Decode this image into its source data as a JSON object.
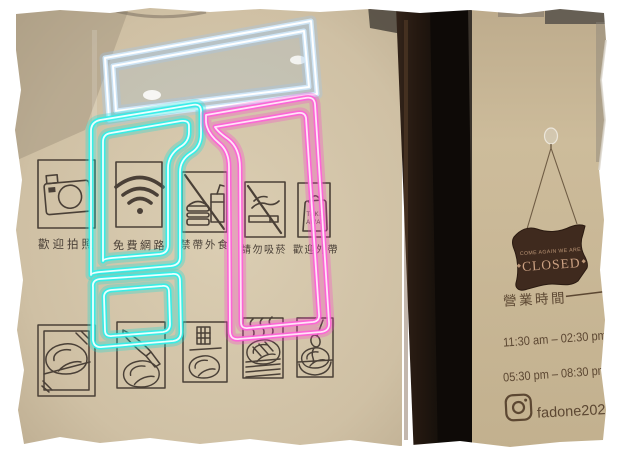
{
  "store": {
    "house_rules": [
      {
        "icon": "camera",
        "label": "歡迎拍照"
      },
      {
        "icon": "wifi",
        "label": "免費網路"
      },
      {
        "icon": "no-outside-food",
        "label": "禁帶外食"
      },
      {
        "icon": "no-smoking",
        "label": "請勿吸菸"
      },
      {
        "icon": "takeaway-bag",
        "label": "歡迎外帶"
      }
    ],
    "takeaway_bag_text": {
      "line1": "TAKE",
      "line2": "AWAY"
    },
    "closed_sign": {
      "top_line": "COME AGAIN WE ARE",
      "main": "CLOSED"
    },
    "hours": {
      "title": "營業時間",
      "lines": [
        "11:30 am – 02:30 pm",
        "05:30 pm – 08:30 pm"
      ]
    },
    "instagram": {
      "handle": "fadone2021"
    },
    "colors": {
      "neon_top": "#cfe8fb",
      "neon_left": "#2ff0ea",
      "neon_right": "#ff5fd8",
      "wall": "#d3c5aa",
      "icon_ink": "#4a4037",
      "hours_ink": "#5c4732",
      "closed_sign_bg": "#3f2a1e",
      "closed_sign_text": "#cda283"
    }
  }
}
